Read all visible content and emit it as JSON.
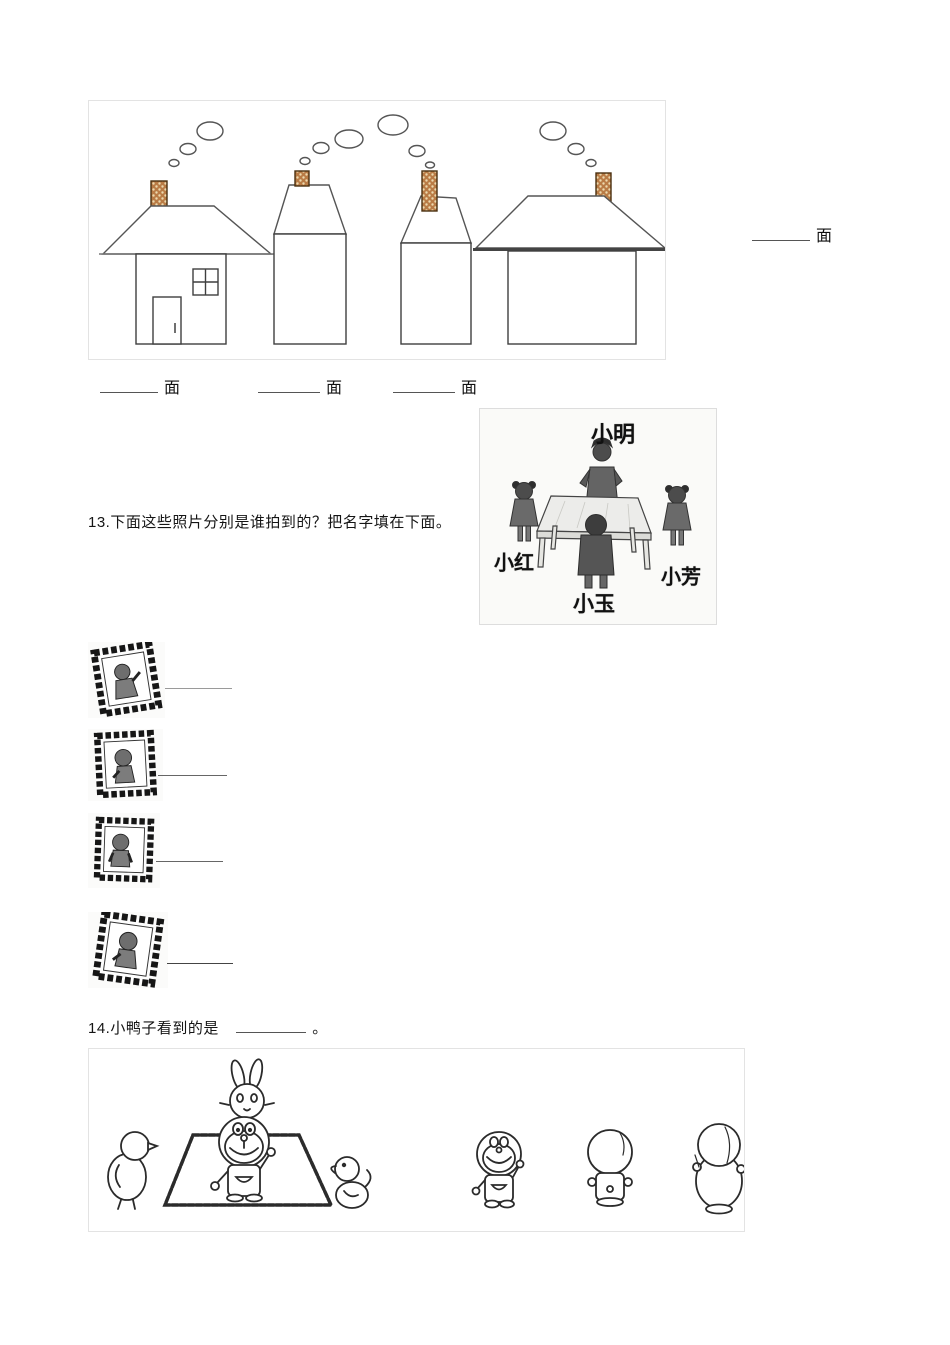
{
  "question12": {
    "unit_label_side": "面",
    "unit_labels_bottom": [
      "面",
      "面",
      "面"
    ]
  },
  "question13": {
    "prompt": "13.下面这些照片分别是谁拍到的？把名字填在下面。",
    "scene_names": {
      "top": "小明",
      "left": "小红",
      "right": "小芳",
      "bottom": "小玉"
    },
    "photo_count": 4
  },
  "question14": {
    "prompt_prefix": "14.小鸭子看到的是",
    "full_stop": "。"
  },
  "colors": {
    "chimney_brick": "#b97b45",
    "chimney_dot": "#ecd9ae",
    "line_art": "#3f3f3f",
    "scan_figure": "#5a5a5a",
    "box_border": "#e3e3e3"
  }
}
